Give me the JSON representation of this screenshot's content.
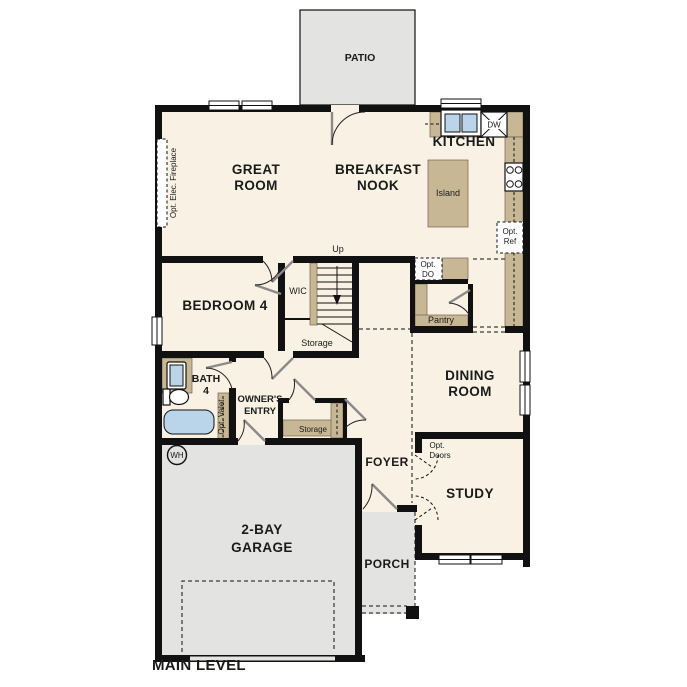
{
  "title": "MAIN LEVEL",
  "colors": {
    "floor": "#f8f1e4",
    "concrete": "#e3e3e1",
    "counter": "#c8b795",
    "fixture_blue": "#bad4ea",
    "wall": "#111111",
    "background": "#ffffff"
  },
  "labels": {
    "patio": "PATIO",
    "great_room_1": "GREAT",
    "great_room_2": "ROOM",
    "breakfast_1": "BREAKFAST",
    "breakfast_2": "NOOK",
    "kitchen": "KITCHEN",
    "island": "Island",
    "dw": "DW",
    "opt_ref_1": "Opt.",
    "opt_ref_2": "Ref",
    "opt_do_1": "Opt.",
    "opt_do_2": "DO",
    "pantry": "Pantry",
    "up": "Up",
    "wic": "WIC",
    "storage_stairs": "Storage",
    "bedroom4": "BEDROOM 4",
    "bath_1": "BATH",
    "bath_2": "4",
    "owners_1": "OWNER'S",
    "owners_2": "ENTRY",
    "opt_valet": "Opt. Valet",
    "storage_closet": "Storage",
    "foyer": "FOYER",
    "dining_1": "DINING",
    "dining_2": "ROOM",
    "study": "STUDY",
    "opt_doors_1": "Opt.",
    "opt_doors_2": "Doors",
    "garage_1": "2-BAY",
    "garage_2": "GARAGE",
    "porch": "PORCH",
    "wh": "WH",
    "fireplace": "Opt. Elec. Fireplace",
    "main_level": "MAIN LEVEL"
  }
}
